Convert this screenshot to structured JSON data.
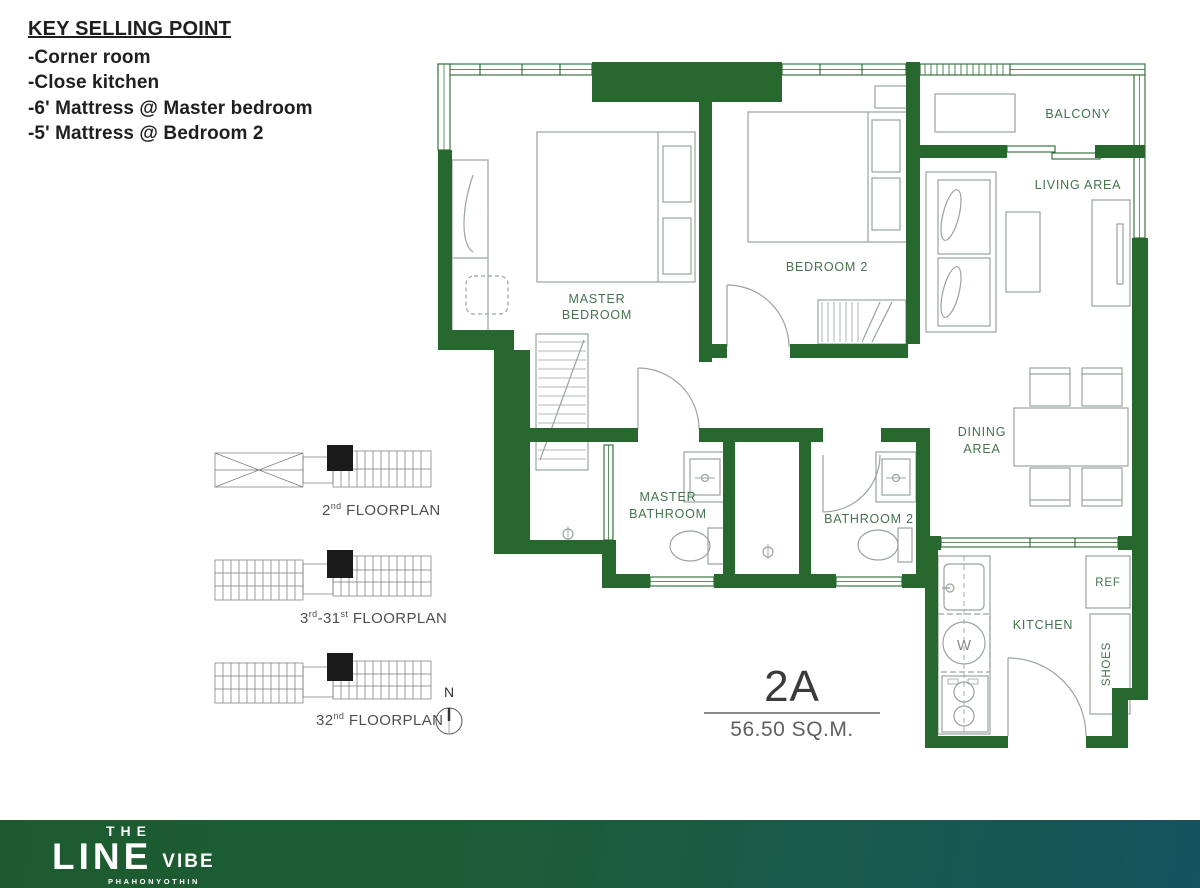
{
  "key_selling_points": {
    "title": "KEY SELLING POINT",
    "items": [
      "-Corner room",
      "-Close kitchen",
      "-6' Mattress @ Master bedroom",
      "-5' Mattress @ Bedroom 2"
    ]
  },
  "plan": {
    "labels": {
      "master_bedroom_1": "MASTER",
      "master_bedroom_2": "BEDROOM",
      "bedroom2": "BEDROOM 2",
      "balcony": "BALCONY",
      "living": "LIVING AREA",
      "dining_1": "DINING",
      "dining_2": "AREA",
      "master_bath_1": "MASTER",
      "master_bath_2": "BATHROOM",
      "bathroom2": "BATHROOM 2",
      "kitchen": "KITCHEN",
      "ref": "REF",
      "shoes": "SHOES",
      "washer": "W"
    },
    "colors": {
      "wall": "#26682e",
      "label": "#44734e",
      "furniture": "#9aa49c"
    }
  },
  "unit": {
    "name": "2A",
    "area": "56.50 SQ.M."
  },
  "floorplans": [
    {
      "parts": [
        {
          "t": "2"
        },
        {
          "t": "nd",
          "sup": true
        },
        {
          "t": " FLOORPLAN"
        }
      ]
    },
    {
      "parts": [
        {
          "t": "3"
        },
        {
          "t": "rd",
          "sup": true
        },
        {
          "t": "-31"
        },
        {
          "t": "st",
          "sup": true
        },
        {
          "t": " FLOORPLAN"
        }
      ]
    },
    {
      "parts": [
        {
          "t": "32"
        },
        {
          "t": "nd",
          "sup": true
        },
        {
          "t": " FLOORPLAN"
        }
      ]
    }
  ],
  "compass": {
    "label": "N"
  },
  "logo": {
    "the": "THE",
    "line": "LINE",
    "vibe": "VIBE",
    "subtitle": "PHAHONYOTHIN"
  }
}
